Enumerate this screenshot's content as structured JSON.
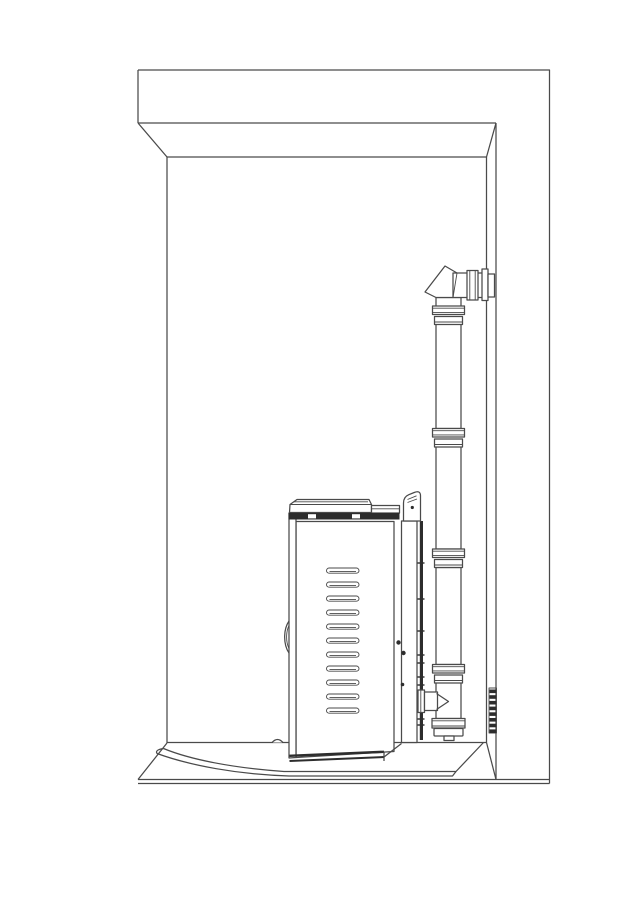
{
  "meta": {
    "title": "Stove in alcove with vertical vent pipe - side installation line drawing",
    "canvas_width": 638,
    "canvas_height": 900
  },
  "palette": {
    "background": "#ffffff",
    "line": "#4a4a4a",
    "dark": "#2d2d2d",
    "fill": "#ffffff"
  },
  "components": {
    "alcove": "Alcove enclosure: header soffit, left wall, right wall return, floor",
    "hearth_pad": "Hearth pad with curved bow front under the stove",
    "stove": "Stove side view: top lid, louvered side panel, door handle, rear heat shield with bracket",
    "vent_pipe": "Vertical vent pipe with slip couplings, 90-degree elbow through wall, flue tee with cleanout cap",
    "wall_grille": "Small louvered vent strip on right wall"
  },
  "louvers": {
    "count": 11,
    "x": 326.5,
    "y_start": 568,
    "pitch": 14,
    "width": 32.5,
    "height": 5.2,
    "rx": 2.6
  },
  "pipe_couplings": {
    "ys": [
      306,
      428.5,
      549,
      664.5
    ]
  },
  "wall_grille": {
    "dash_count": 8,
    "x": 489.5,
    "y_start": 689.5,
    "pitch": 5.7,
    "width": 6.8,
    "height": 3.6
  },
  "rear_panel_ticks": {
    "ys": [
      563,
      599,
      631,
      655,
      663,
      677,
      685,
      699,
      705,
      719,
      725
    ]
  },
  "screw_dots": [
    {
      "x": 398.5,
      "y": 642.5,
      "r": 2.2
    },
    {
      "x": 403.5,
      "y": 653.0,
      "r": 2.2
    },
    {
      "x": 402.5,
      "y": 684.5,
      "r": 1.8
    }
  ],
  "bracket_dot": {
    "x": 412.3,
    "y": 507.5,
    "r": 1.6
  }
}
